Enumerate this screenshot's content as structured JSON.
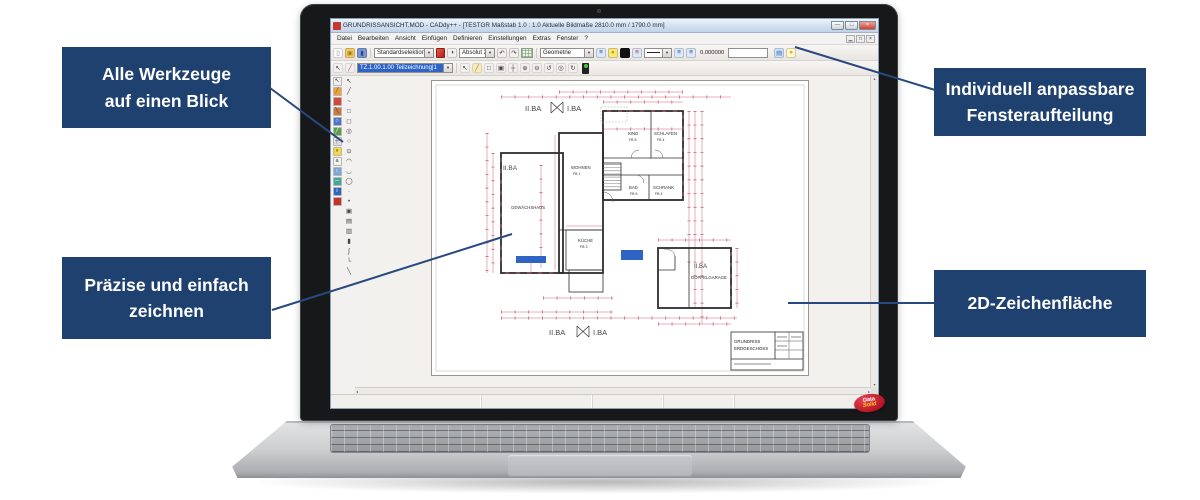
{
  "colors": {
    "navy": "#1e4170",
    "connector": "#27497f",
    "sel": "#2f63c4",
    "dim": "#c4556a",
    "logo_red": "#b01320",
    "logo_yellow": "#f5d020"
  },
  "ui": {
    "dropdown_arrow": "▾",
    "scroll_left": "◂",
    "scroll_right": "▸",
    "scroll_up": "▴",
    "scroll_down": "▾"
  },
  "callouts": {
    "tools": {
      "lines": [
        "Alle Werkzeuge",
        "auf einen Blick"
      ]
    },
    "window_layout": {
      "lines": [
        "Individuell anpassbare",
        "Fensteraufteilung"
      ]
    },
    "drawing": {
      "lines": [
        "Präzise und einfach",
        "zeichnen"
      ]
    },
    "canvas2d": {
      "lines": [
        "2D-Zeichenfläche"
      ]
    }
  },
  "brand": {
    "top": "Data",
    "bottom": "Solid"
  },
  "app": {
    "title": "GRUNDRISSANSICHT.MOD - CADdy++ - [TESTGR   Maßstab 1.0 : 1.0   Aktuelle Bildmaße 2810.0 mm / 1790.0 mm]",
    "window_buttons": [
      {
        "name": "minimize-button",
        "glyph": "—"
      },
      {
        "name": "maximize-button",
        "glyph": "□"
      },
      {
        "name": "close-button",
        "glyph": "×"
      }
    ],
    "menu": [
      "Datei",
      "Bearbeiten",
      "Ansicht",
      "Einfügen",
      "Definieren",
      "Einstellungen",
      "Extras",
      "Fenster",
      "?"
    ],
    "mdi_buttons": [
      {
        "name": "mdi-minimize-button",
        "glyph": "▁"
      },
      {
        "name": "mdi-restore-button",
        "glyph": "□"
      },
      {
        "name": "mdi-close-button",
        "glyph": "×"
      }
    ],
    "toolbar_main": {
      "file_icons": [
        {
          "name": "new-file-icon",
          "glyph": "▯",
          "bg": "#fdfdfd",
          "fg": "#8a8a8a"
        },
        {
          "name": "open-file-icon",
          "glyph": "▣",
          "bg": "#f2cf68",
          "fg": "#a57c1b"
        },
        {
          "name": "save-file-icon",
          "glyph": "▮",
          "bg": "#7d97d2",
          "fg": "#2c4a8a"
        }
      ],
      "selection_combo": "Standardselektion",
      "mode_icon_glyph": "◑",
      "coord_combo": "Absolut 2D",
      "undo_glyph": "↶",
      "redo_glyph": "↷",
      "group_combo": "Geometrie",
      "format_icons": [
        {
          "name": "pen-layer-icon",
          "glyph": "≡",
          "bg": "#dce9fb",
          "fg": "#2c4a8a"
        },
        {
          "name": "highlight-bulb-icon",
          "glyph": "●",
          "bg": "#f7e97f",
          "fg": "#c2a60a"
        },
        {
          "name": "color-swatch-black-icon",
          "glyph": "",
          "bg": "#111111",
          "fg": "#ffffff"
        },
        {
          "name": "layer-move-icon",
          "glyph": "≡",
          "bg": "#dce9fb",
          "fg": "#b03030"
        }
      ],
      "value_icons": [
        {
          "name": "layer-z-icon",
          "glyph": "≡",
          "bg": "#dce9fb",
          "fg": "#2c4a8a"
        },
        {
          "name": "layer-z2-icon",
          "glyph": "≡",
          "bg": "#dce9fb",
          "fg": "#2c4a8a"
        }
      ],
      "value": "0.000000",
      "right_icons": [
        {
          "name": "folder-blue-icon",
          "glyph": "▤",
          "bg": "#cfe3fa",
          "fg": "#3668b0"
        },
        {
          "name": "bulb-icon",
          "glyph": "●",
          "bg": "#fff7cf",
          "fg": "#d9b60c"
        }
      ]
    },
    "toolbar_drawing": {
      "lead_icons": [
        {
          "name": "pointer-icon",
          "glyph": "↖",
          "bg": "#f2f0ee",
          "fg": "#444444"
        },
        {
          "name": "pen-red-icon",
          "glyph": "╱",
          "bg": "#f2f0ee",
          "fg": "#b05050"
        }
      ],
      "combo": "TZ.1.00.1.00 Teilzeichnung|1",
      "icons": [
        {
          "name": "draw-pointer-icon",
          "glyph": "↖",
          "bg": "#f2f0ee",
          "fg": "#444444"
        },
        {
          "name": "pen-yellow-icon",
          "glyph": "╱",
          "bg": "#f7ecc0",
          "fg": "#8f7a20"
        },
        {
          "name": "select-window-icon",
          "glyph": "□",
          "bg": "#f2f0ee",
          "fg": "#444444"
        },
        {
          "name": "zoom-window-icon",
          "glyph": "▣",
          "bg": "#f2f0ee",
          "fg": "#444444"
        },
        {
          "name": "pan-icon",
          "glyph": "┼",
          "bg": "#f2f0ee",
          "fg": "#444444"
        },
        {
          "name": "zoom-in-icon",
          "glyph": "⊕",
          "bg": "#f2f0ee",
          "fg": "#444444"
        },
        {
          "name": "zoom-out-icon",
          "glyph": "⊖",
          "bg": "#f2f0ee",
          "fg": "#444444"
        },
        {
          "name": "zoom-previous-icon",
          "glyph": "↺",
          "bg": "#f2f0ee",
          "fg": "#444444"
        },
        {
          "name": "zoom-all-icon",
          "glyph": "◎",
          "bg": "#f2f0ee",
          "fg": "#444444"
        },
        {
          "name": "redraw-icon",
          "glyph": "↻",
          "bg": "#f2f0ee",
          "fg": "#444444"
        }
      ]
    },
    "palette_system": [
      {
        "name": "select-tool",
        "glyph": "↖",
        "bg": "#efefef",
        "fg": "#222222"
      },
      {
        "name": "pencil-tool",
        "glyph": "╱",
        "bg": "#f0a23c",
        "fg": "#7a4a10"
      },
      {
        "name": "brush-tool",
        "glyph": "",
        "bg": "#d14b3c",
        "fg": "#ffffff"
      },
      {
        "name": "knife-tool",
        "glyph": "╲",
        "bg": "#c87a3e",
        "fg": "#5d330f"
      },
      {
        "name": "zoom-tool",
        "glyph": "○",
        "bg": "#4a76c9",
        "fg": "#ffffff"
      },
      {
        "name": "green-pen-tool",
        "glyph": "╱",
        "bg": "#5a9e4b",
        "fg": "#ffffff"
      },
      {
        "name": "snap-tool",
        "glyph": "┼",
        "bg": "#dddddd",
        "fg": "#555555"
      },
      {
        "name": "light-tool",
        "glyph": "●",
        "bg": "#f3d74a",
        "fg": "#a8881a"
      },
      {
        "name": "text-tool",
        "glyph": "a",
        "bg": "#f4f4f4",
        "fg": "#333333"
      },
      {
        "name": "move-tool",
        "glyph": "↕",
        "bg": "#7aa7d9",
        "fg": "#ffffff"
      },
      {
        "name": "measure-tool",
        "glyph": "─",
        "bg": "#3fa6a0",
        "fg": "#ffffff"
      },
      {
        "name": "info-tool",
        "glyph": "i",
        "bg": "#2f63c4",
        "fg": "#ffffff"
      },
      {
        "name": "eraser-tool",
        "glyph": "",
        "bg": "#c2332a",
        "fg": "#ffffff"
      }
    ],
    "palette_geometry": [
      {
        "name": "geo-select-tool",
        "glyph": "↖"
      },
      {
        "name": "line-tool",
        "glyph": "╱"
      },
      {
        "name": "freehand-tool",
        "glyph": "~"
      },
      {
        "name": "rectangle-tool",
        "glyph": "□"
      },
      {
        "name": "rounded-rect-tool",
        "glyph": "◻"
      },
      {
        "name": "circle-center-tool",
        "glyph": "◎"
      },
      {
        "name": "circle-radius-tool",
        "glyph": "○"
      },
      {
        "name": "circle-2point-tool",
        "glyph": "⊙"
      },
      {
        "name": "arc-tool",
        "glyph": "◠"
      },
      {
        "name": "arc-3point-tool",
        "glyph": "◡"
      },
      {
        "name": "ellipse-tool",
        "glyph": "◯"
      },
      {
        "name": "point-tool",
        "glyph": "·"
      },
      {
        "name": "point-mark-tool",
        "glyph": "•"
      },
      {
        "name": "copy-shape-tool",
        "glyph": "▣"
      },
      {
        "name": "hatch-tool",
        "glyph": "▤"
      },
      {
        "name": "hatch-pattern-tool",
        "glyph": "▥"
      },
      {
        "name": "column-tool",
        "glyph": "▮"
      },
      {
        "name": "spline-tool",
        "glyph": "∫"
      },
      {
        "name": "corner-tool",
        "glyph": "└"
      },
      {
        "name": "chamfer-tool",
        "glyph": "╲"
      }
    ]
  },
  "plan": {
    "labels": {
      "top_left": "II.BA",
      "top_right": "I.BA",
      "bottom_left": "II.BA",
      "bottom_right": "I.BA",
      "left_wing": "II.BA",
      "garage": "II.BA"
    },
    "rooms": [
      {
        "label": "WOHNEN",
        "sub": "FB 1"
      },
      {
        "label": "KIND",
        "sub": "FB 8"
      },
      {
        "label": "SCHLAFEN",
        "sub": "FB 4"
      },
      {
        "label": "BAD",
        "sub": "FB 6"
      },
      {
        "label": "SCHRANK",
        "sub": "FB 4"
      },
      {
        "label": "KÜCHE",
        "sub": "FB 3"
      },
      {
        "label": "GEWÄCHSHAUS",
        "sub": ""
      },
      {
        "label": "DOPPELGARAGE",
        "sub": ""
      }
    ],
    "titleblock": {
      "line1": "GRUNDRISS",
      "line2": "ERDGESCHOSS"
    }
  }
}
